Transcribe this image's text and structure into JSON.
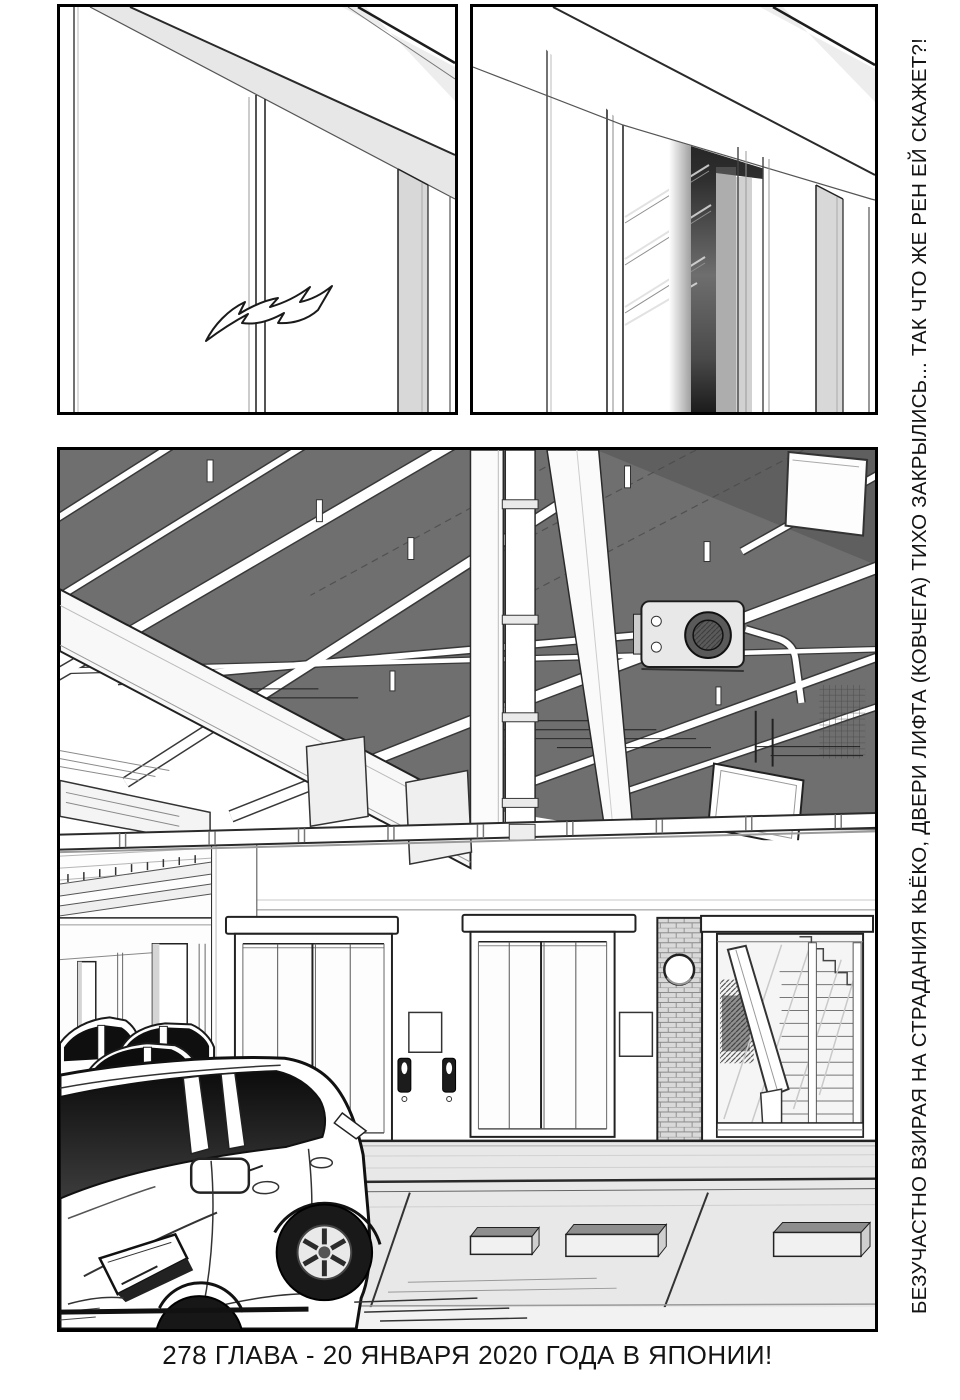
{
  "page": {
    "side_text": "БЕЗУЧАСТНО ВЗИРАЯ НА СТРАДАНИЯ КЬЁКО, ДВЕРИ ЛИФТА (КОВЧЕГА) ТИХО ЗАКРЫЛИСЬ... ТАК ЧТО ЖЕ РЕН ЕЙ СКАЖЕТ?!",
    "bottom_caption": "278 ГЛАВА - 20 ЯНВАРЯ 2020 ГОДА В ЯПОНИИ!"
  },
  "colors": {
    "paper": "#ffffff",
    "ink": "#141414",
    "ceiling_tone": "#6f6f6f",
    "floor_tone": "#e8e8e8",
    "mid_tone": "#d8d8d8"
  }
}
